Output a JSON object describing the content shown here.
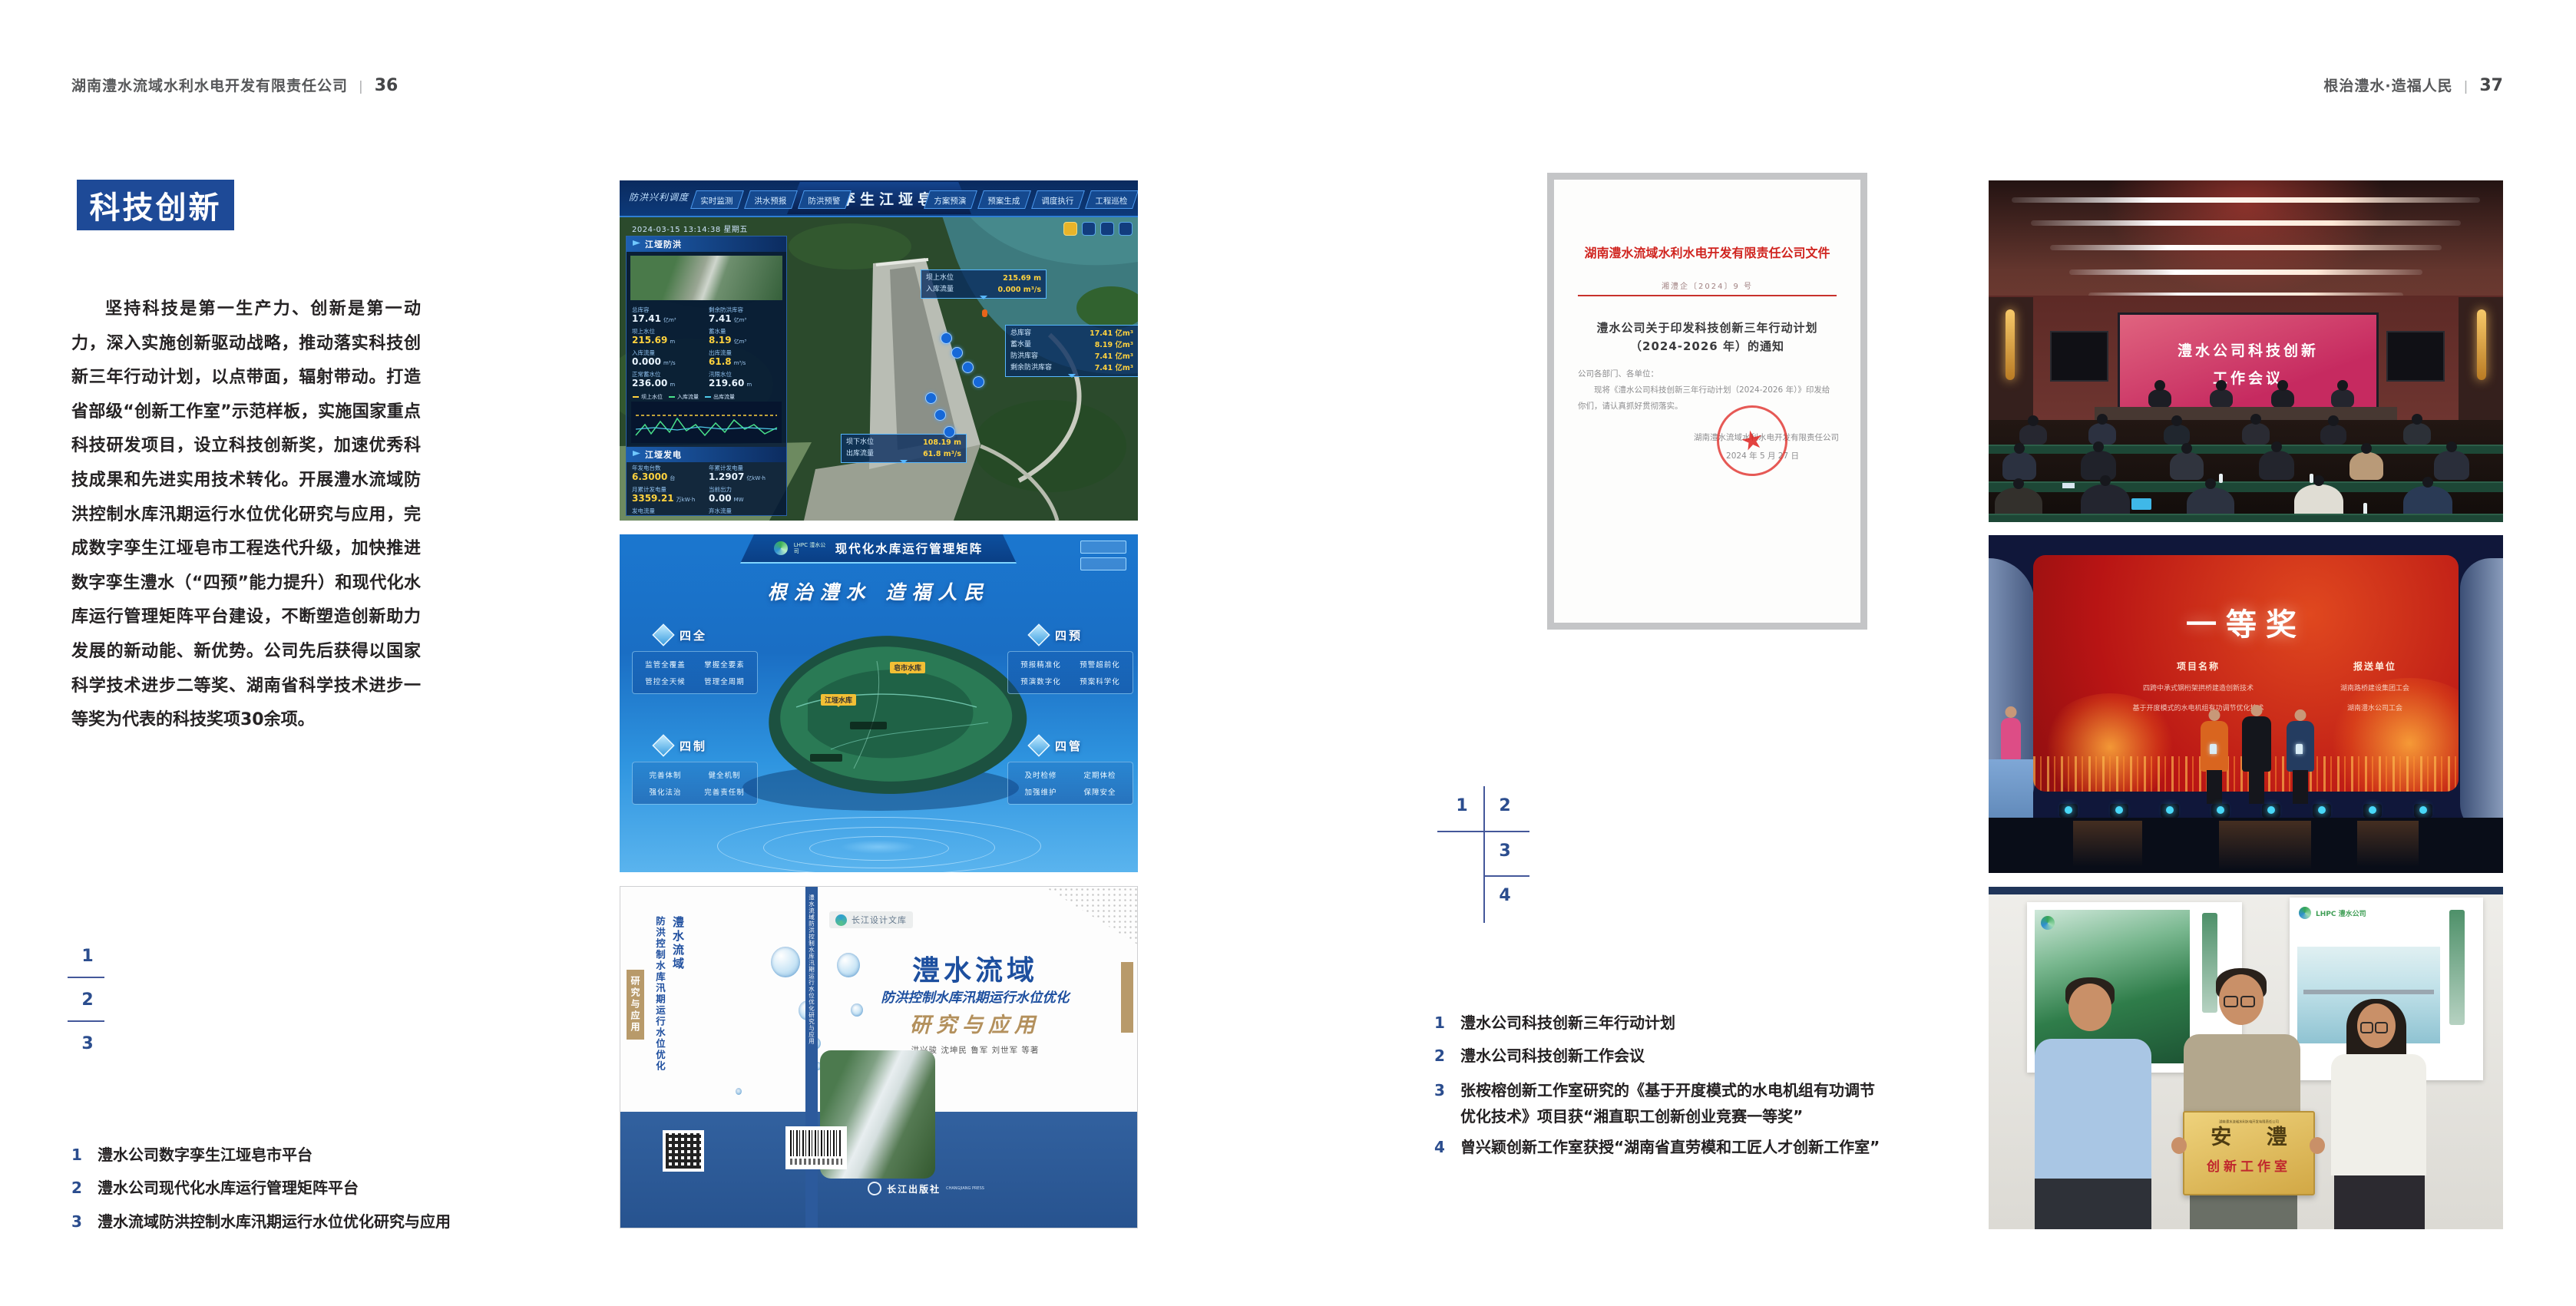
{
  "left_page": {
    "header": {
      "company": "湖南澧水流域水利水电开发有限责任公司",
      "divider": "|",
      "page_no": "36"
    },
    "section_badge": "科技创新",
    "paragraph": "坚持科技是第一生产力、创新是第一动力，深入实施创新驱动战略，推动落实科技创新三年行动计划，以点带面，辐射带动。打造省部级“创新工作室”示范样板，实施国家重点科技研发项目，设立科技创新奖，加速优秀科技成果和先进实用技术转化。开展澧水流域防洪控制水库汛期运行水位优化研究与应用，完成数字孪生江垭皂市工程迭代升级，加快推进数字孪生澧水（“四预”能力提升）和现代化水库运行管理矩阵平台建设，不断塑造创新助力发展的新动能、新优势。公司先后获得以国家科学技术进步二等奖、湖南省科学技术进步一等奖为代表的科技奖项30余项。",
    "figure_key": [
      "1",
      "2",
      "3"
    ],
    "captions": [
      {
        "num": "1",
        "text": "澧水公司数字孪生江垭皂市平台"
      },
      {
        "num": "2",
        "text": "澧水公司现代化水库运行管理矩阵平台"
      },
      {
        "num": "3",
        "text": "澧水流域防洪控制水库汛期运行水位优化研究与应用"
      }
    ]
  },
  "right_page": {
    "header": {
      "slogan": "根治澧水·造福人民",
      "divider": "|",
      "page_no": "37"
    },
    "figure_key": [
      "1",
      "2",
      "3",
      "4"
    ],
    "captions": [
      {
        "num": "1",
        "lines": [
          "澧水公司科技创新三年行动计划"
        ]
      },
      {
        "num": "2",
        "lines": [
          "澧水公司科技创新工作会议"
        ]
      },
      {
        "num": "3",
        "lines": [
          "张桉榕创新工作室研究的《基于开度模式的水电机组有功调节",
          "优化技术》项目获“湘直职工创新创业竞赛一等奖”"
        ]
      },
      {
        "num": "4",
        "lines": [
          "曾兴颖创新工作室获授“湖南省直劳模和工匠人才创新工作室”"
        ]
      }
    ]
  },
  "figures": {
    "dashboard": {
      "brand": "防洪兴利调度",
      "title": "数字孪生江垭皂市",
      "tabs_left": [
        "实时监测",
        "洪水预报",
        "防洪预警"
      ],
      "tabs_right": [
        "方案预演",
        "预案生成",
        "调度执行",
        "工程巡检"
      ],
      "timestamp": "2024-03-15 13:14:38 星期五",
      "panel_flood_title": "江垭防洪",
      "flood_stats": [
        {
          "label": "总库容",
          "value": "17.41",
          "unit": "亿m³"
        },
        {
          "label": "剩余防洪库容",
          "value": "7.41",
          "unit": "亿m³"
        },
        {
          "label": "坝上水位",
          "value": "215.69",
          "unit": "m"
        },
        {
          "label": "蓄水量",
          "value": "8.19",
          "unit": "亿m³"
        },
        {
          "label": "入库流量",
          "value": "0.000",
          "unit": "m³/s"
        },
        {
          "label": "出库流量",
          "value": "61.8",
          "unit": "m³/s"
        },
        {
          "label": "正常蓄水位",
          "value": "236.00",
          "unit": "m"
        },
        {
          "label": "汛限水位",
          "value": "219.60",
          "unit": "m"
        }
      ],
      "chart_legend": [
        "坝上水位",
        "入库流量",
        "出库流量"
      ],
      "panel_power_title": "江垭发电",
      "power_stats": [
        {
          "label": "年发电台数",
          "value": "6.3000",
          "unit": "台"
        },
        {
          "label": "年累计发电量",
          "value": "1.2907",
          "unit": "亿kW·h"
        },
        {
          "label": "月累计发电量",
          "value": "3359.21",
          "unit": "万kW·h"
        },
        {
          "label": "当前出力",
          "value": "0.00",
          "unit": "MW"
        },
        {
          "label": "发电流量",
          "value": "0.00",
          "unit": "m³/s"
        },
        {
          "label": "弃水流量",
          "value": "0.00",
          "unit": "m³/s"
        }
      ],
      "callout_upstream": [
        {
          "label": "坝上水位",
          "value": "215.69 m"
        },
        {
          "label": "入库流量",
          "value": "0.000 m³/s"
        }
      ],
      "callout_capacity": [
        {
          "label": "总库容",
          "value": "17.41 亿m³"
        },
        {
          "label": "蓄水量",
          "value": "8.19 亿m³"
        },
        {
          "label": "防洪库容",
          "value": "7.41 亿m³"
        },
        {
          "label": "剩余防洪库容",
          "value": "7.41 亿m³"
        }
      ],
      "callout_downstream": [
        {
          "label": "坝下水位",
          "value": "108.19 m"
        },
        {
          "label": "出库流量",
          "value": "61.8 m³/s"
        }
      ]
    },
    "matrix": {
      "logo_text": "LHPC 澧水公司",
      "title": "现代化水库运行管理矩阵",
      "slogan": "根治澧水 造福人民",
      "panels": [
        {
          "title": "四全",
          "items": [
            "监管全覆盖",
            "掌握全要素",
            "管控全天候",
            "管理全周期"
          ]
        },
        {
          "title": "四预",
          "items": [
            "预报精准化",
            "预警超前化",
            "预演数字化",
            "预案科学化"
          ]
        },
        {
          "title": "四制",
          "items": [
            "完善体制",
            "健全机制",
            "强化法治",
            "完善责任制"
          ]
        },
        {
          "title": "四管",
          "items": [
            "及时检修",
            "定期体检",
            "加强维护",
            "保障安全"
          ]
        }
      ],
      "map_tags": [
        "皂市水库",
        "江垭水库"
      ]
    },
    "book": {
      "series_tag": "长江设计文库",
      "title_region": "澧水流域",
      "title_main": "防洪控制水库汛期运行水位优化",
      "title_sub": "研究与应用",
      "authors": "洪兴骏 沈坤民 鲁军 刘世军 等著",
      "publisher": "长江出版社",
      "publisher_latin": "CHANGJIANG PRESS",
      "spine_text": "澧水流域防洪控制水库汛期运行水位优化研究与应用"
    },
    "document": {
      "header": "湖南澧水流域水利水电开发有限责任公司文件",
      "doc_no": "湘澧企〔2024〕9 号",
      "title_line1": "澧水公司关于印发科技创新三年行动计划",
      "title_line2": "（2024-2026 年）的通知",
      "salutation": "公司各部门、各单位：",
      "body": "现将《澧水公司科技创新三年行动计划（2024-2026 年）》印发给你们，请认真抓好贯彻落实。",
      "signer": "湖南澧水流域水利水电开发有限责任公司",
      "date": "2024 年 5 月 27 日"
    },
    "meeting": {
      "screen_line1": "澧水公司科技创新",
      "screen_line2": "工作会议"
    },
    "award": {
      "headline": "一等奖",
      "col1_header": "项目名称",
      "col1_items": [
        "四跨中承式钢桁架拱桥建造创新技术",
        "基于开度模式的水电机组有功调节优化技术"
      ],
      "col2_header": "报送单位",
      "col2_items": [
        "湖南路桥建设集团工会",
        "湖南澧水公司工会"
      ]
    },
    "workshop": {
      "plaque_org": "湖南澧水流域水利水电开发有限责任公司",
      "plaque_title": "安 澧",
      "plaque_subtitle": "创新工作室",
      "poster_logo": "LHPC 澧水公司"
    }
  }
}
